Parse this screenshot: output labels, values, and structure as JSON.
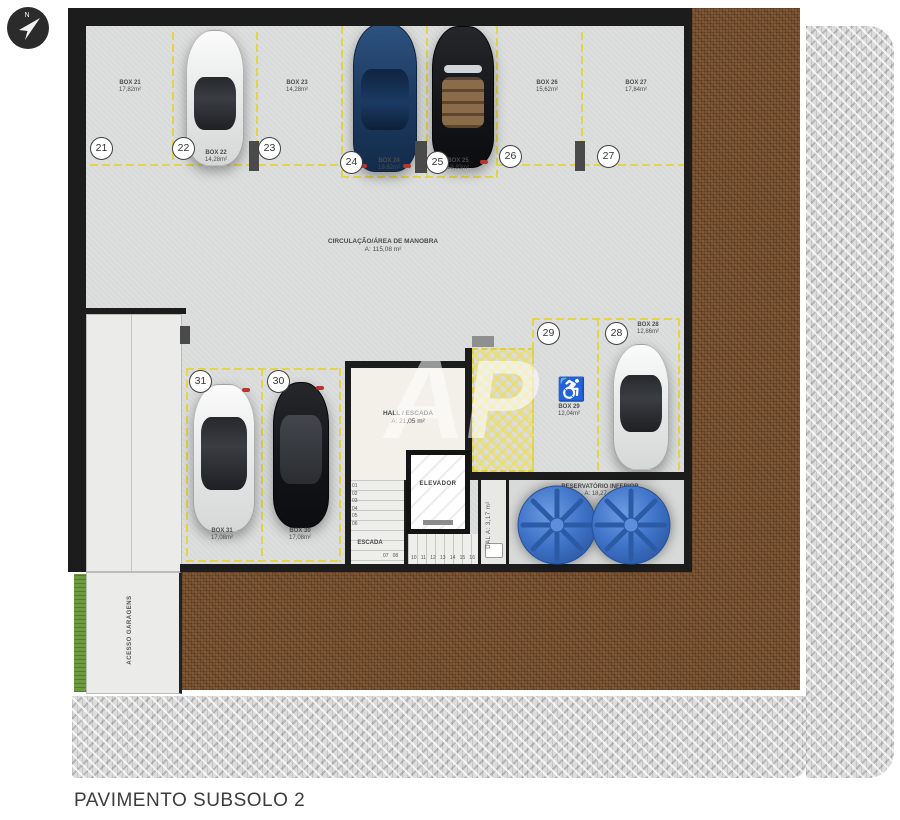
{
  "title": "PAVIMENTO SUBSOLO 2",
  "north": {
    "label": "N"
  },
  "watermark": {
    "text": "AP"
  },
  "colors": {
    "floor": "#d9dbda",
    "wall": "#1c1c1c",
    "parking_line": "#e3d44a",
    "earth_fill": "#7a5230",
    "paver": "#dcdcdc",
    "grass": "#6d9a40",
    "reservoir_blue": "#3f74c9",
    "hatch_yellow": "#eede55"
  },
  "rooms": {
    "circulation": {
      "label": "CIRCULAÇÃO/ÁREA DE MANOBRA",
      "area": "A: 115,08 m²"
    },
    "hall": {
      "label": "HALL / ESCADA",
      "area": "A: 21,05 m²"
    },
    "elevator": {
      "label": "ELEVADOR"
    },
    "stairs": {
      "label": "ESCADA"
    },
    "dal": {
      "label": "DAL",
      "area": "A: 3,17 m²"
    },
    "reservoir": {
      "label": "RESERVATÓRIO INFERIOR",
      "area": "A: 18,27 m²"
    },
    "garage_access": {
      "label": "ACESSO GARAGENS"
    }
  },
  "boxes": [
    {
      "num": "21",
      "label": "BOX 21",
      "area": "17,82m²"
    },
    {
      "num": "22",
      "label": "BOX 22",
      "area": "14,28m²"
    },
    {
      "num": "23",
      "label": "BOX 23",
      "area": "14,28m²"
    },
    {
      "num": "24",
      "label": "BOX 24",
      "area": "19,82m²"
    },
    {
      "num": "25",
      "label": "BOX 25",
      "area": "19,83m²"
    },
    {
      "num": "26",
      "label": "BOX 26",
      "area": "15,62m²"
    },
    {
      "num": "27",
      "label": "BOX 27",
      "area": "17,84m²"
    },
    {
      "num": "28",
      "label": "BOX 28",
      "area": "12,86m²"
    },
    {
      "num": "29",
      "label": "BOX 29",
      "area": "12,04m²"
    },
    {
      "num": "30",
      "label": "BOX 30",
      "area": "17,08m²"
    },
    {
      "num": "31",
      "label": "BOX 31",
      "area": "17,08m²"
    }
  ],
  "stair_steps": {
    "left": [
      "01",
      "02",
      "03",
      "04",
      "05",
      "06"
    ],
    "mid": [
      "07",
      "08"
    ],
    "bottom": [
      "10",
      "11",
      "12",
      "13",
      "14",
      "15",
      "16"
    ]
  },
  "accessible_symbol": "♿"
}
